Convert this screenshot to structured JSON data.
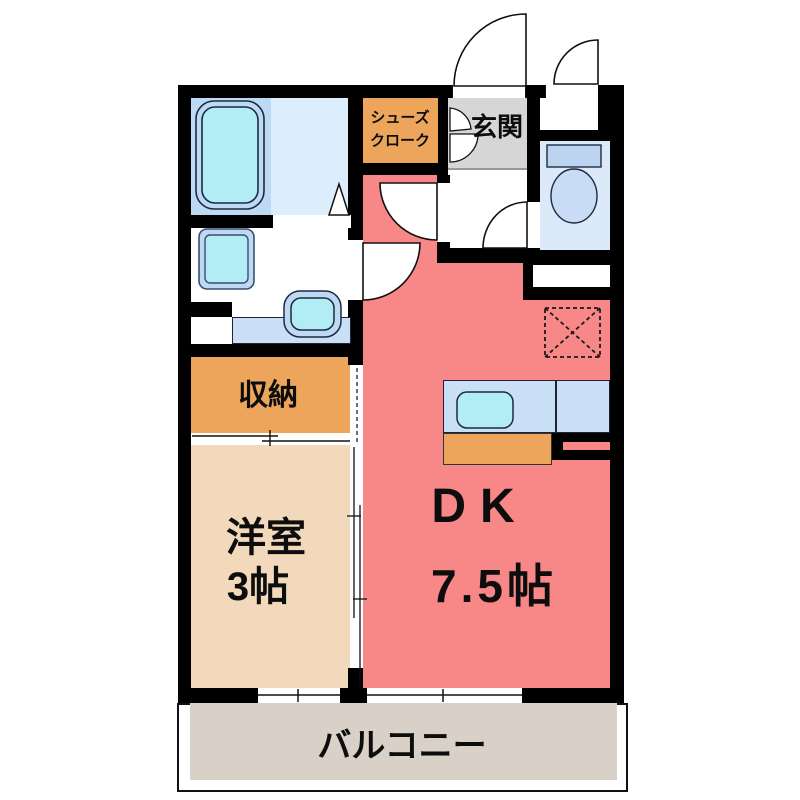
{
  "figure": "apartment-floor-plan",
  "labels": {
    "shoe_closet_line1": "シューズ",
    "shoe_closet_line2": "クローク",
    "entrance": "玄関",
    "storage": "収納",
    "western_room_name": "洋室",
    "western_room_size": "3帖",
    "dining_kitchen": "DK",
    "dining_kitchen_size": "7.5帖",
    "balcony": "バルコニー"
  },
  "rooms": [
    {
      "id": "dining_kitchen",
      "label": "DK",
      "size": "7.5帖"
    },
    {
      "id": "western_room",
      "label": "洋室",
      "size": "3帖"
    },
    {
      "id": "storage",
      "label": "収納"
    },
    {
      "id": "shoe_closet",
      "label": "シューズクローク"
    },
    {
      "id": "entrance",
      "label": "玄関"
    },
    {
      "id": "balcony",
      "label": "バルコニー"
    },
    {
      "id": "bathroom",
      "label": ""
    },
    {
      "id": "washroom",
      "label": ""
    },
    {
      "id": "toilet",
      "label": ""
    }
  ],
  "colors": {
    "wall": "#000000",
    "dk_floor": "#F88787",
    "western_room_floor": "#F2D9BC",
    "storage_fill": "#EDA55B",
    "entrance_floor": "#D6D6D6",
    "balcony_floor": "#D9D0C8",
    "bath_floor": "#BDD9F3",
    "bath_floor_light": "#DCEDFB",
    "fixture_cyan": "#B2ECF5",
    "counter_blue": "#C9DFF6",
    "toilet_floor": "#DCE9F8",
    "toilet_tank": "#BCD4EF",
    "toilet_bowl": "#C8DCF5"
  }
}
